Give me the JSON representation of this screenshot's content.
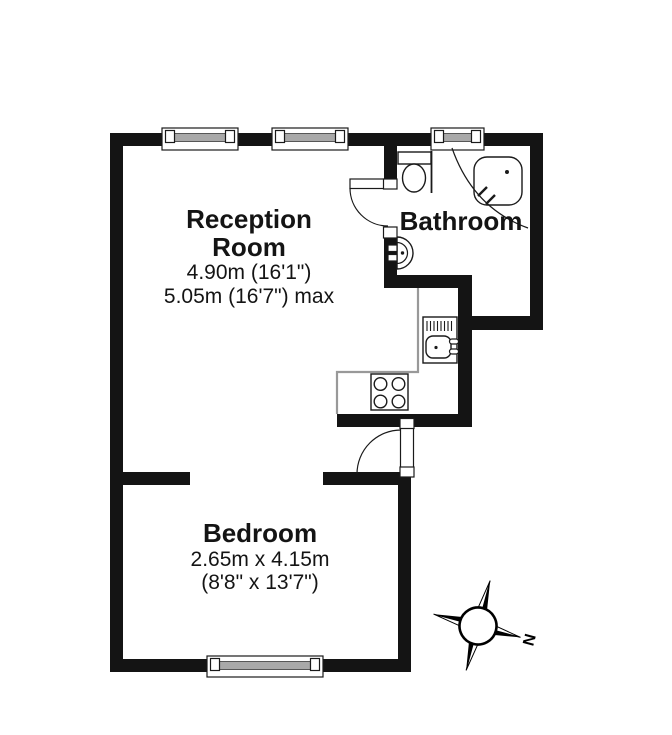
{
  "floorplan": {
    "reception": {
      "label_line1": "Reception",
      "label_line2": "Room",
      "dimension_1": "4.90m (16'1\")",
      "dimension_2": "5.05m (16'7\") max"
    },
    "bathroom": {
      "label": "Bathroom"
    },
    "bedroom": {
      "label": "Bedroom",
      "dimension_1": "2.65m x 4.15m",
      "dimension_2": "(8'8\" x 13'7\")"
    },
    "compass": {
      "north_label": "N"
    },
    "colors": {
      "wall": "#141414",
      "floor": "#ffffff",
      "window_glass": "#a9a9a9",
      "counter_outline": "#999999"
    }
  }
}
